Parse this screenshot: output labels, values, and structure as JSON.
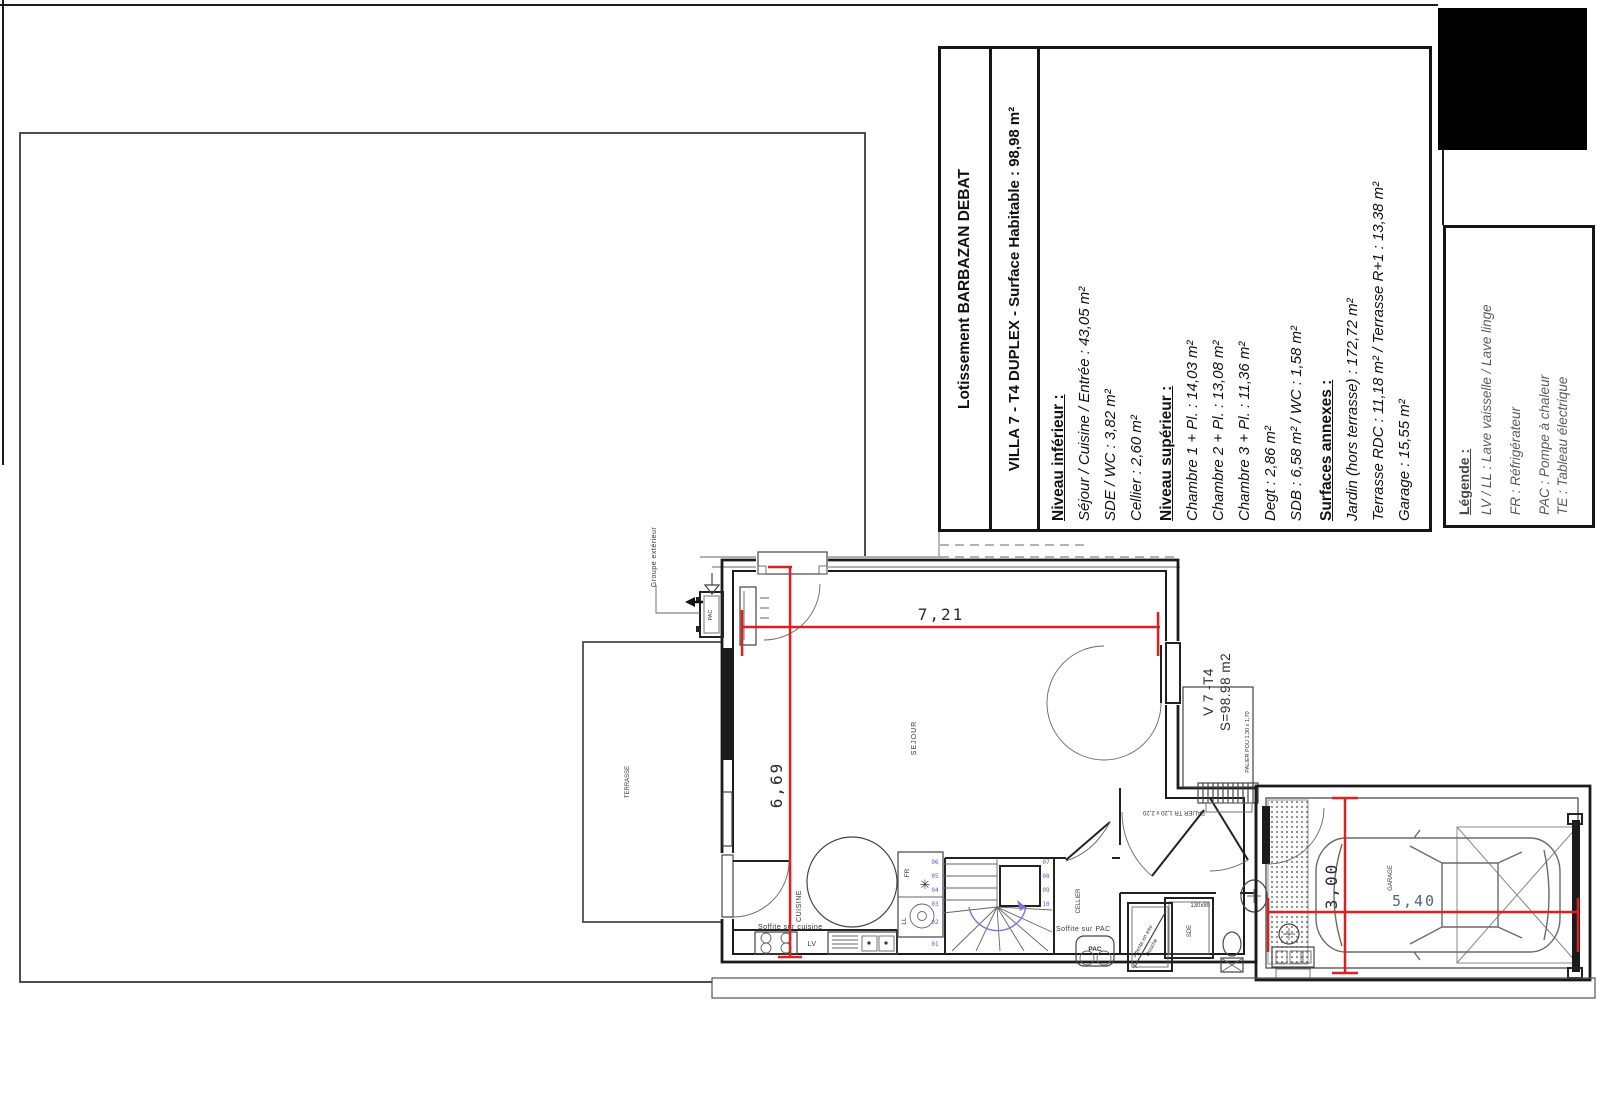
{
  "info_panel": {
    "project": "Lotissement BARBAZAN DEBAT",
    "title": "VILLA 7 - T4 DUPLEX - Surface Habitable : 98,98 m²",
    "sections": [
      {
        "heading": "Niveau inférieur :",
        "lines": [
          "Séjour / Cuisine / Entrée : 43,05 m²",
          "SDE / WC : 3,82 m²",
          "Cellier : 2,60 m²"
        ]
      },
      {
        "heading": "Niveau supérieur :",
        "lines": [
          "Chambre 1 + Pl. : 14,03 m²",
          "Chambre 2 + Pl. : 13,08 m²",
          "Chambre 3 + Pl. : 11,36 m²",
          "Degt : 2,86 m²",
          "SDB : 6,58 m² / WC : 1,58 m²"
        ]
      },
      {
        "heading": "Surfaces annexes :",
        "lines": [
          "Jardin (hors terrasse) : 172,72 m²",
          "Terrasse RDC : 11,18 m² / Terrasse R+1 : 13,38 m²",
          "Garage : 15,55 m²"
        ]
      }
    ]
  },
  "legend": {
    "heading": "Légende :",
    "items": [
      "LV / LL : Lave vaisselle / Lave linge",
      "FR : Réfrigérateur",
      "PAC : Pompe à chaleur",
      "TE : Tableau électrique"
    ]
  },
  "plan": {
    "labels": {
      "terrasse": "TERRASSE",
      "sejour": "SEJOUR",
      "cuisine": "CUISINE",
      "cellier": "CELLIER",
      "sde": "SDE",
      "garage": "GARAGE",
      "pac_unit": "PAC",
      "pac_indoor": "PAC",
      "fr": "FR",
      "ll": "LL",
      "lv": "LV",
      "soffite_cuisine": "Soffite sur cuisine",
      "soffite_pac": "Soffite sur PAC",
      "groupe_exterieur": "Groupe extérieur",
      "villa_ref": "V 7 -T4",
      "villa_surface": "S=98.98 m2",
      "palier_pou": "PALIER POU 1,30 x 1,70",
      "palier_tr": "PALIER TR 1,20 x 2,20",
      "shower_size": "130x80",
      "attente_line1": "Attente en eau",
      "attente_line2": "Douche"
    },
    "icons": {
      "snowflake": "✳"
    },
    "dimensions": {
      "sejour_width": "7,21",
      "sejour_height": "6,69",
      "garage_length": "5,40",
      "garage_width": "3,00"
    },
    "stairs": {
      "left": [
        "06",
        "05",
        "04",
        "03",
        "02",
        "01"
      ],
      "right": [
        "07",
        "08",
        "09",
        "10"
      ]
    }
  },
  "colors": {
    "dim_red": "#e02020",
    "stairs_blue": "#7878e0",
    "wall": "#1b1b1b",
    "boundary": "#4d4d4d",
    "dim_text": "#2b2b2b",
    "dim_text_blue": "#51657a"
  }
}
